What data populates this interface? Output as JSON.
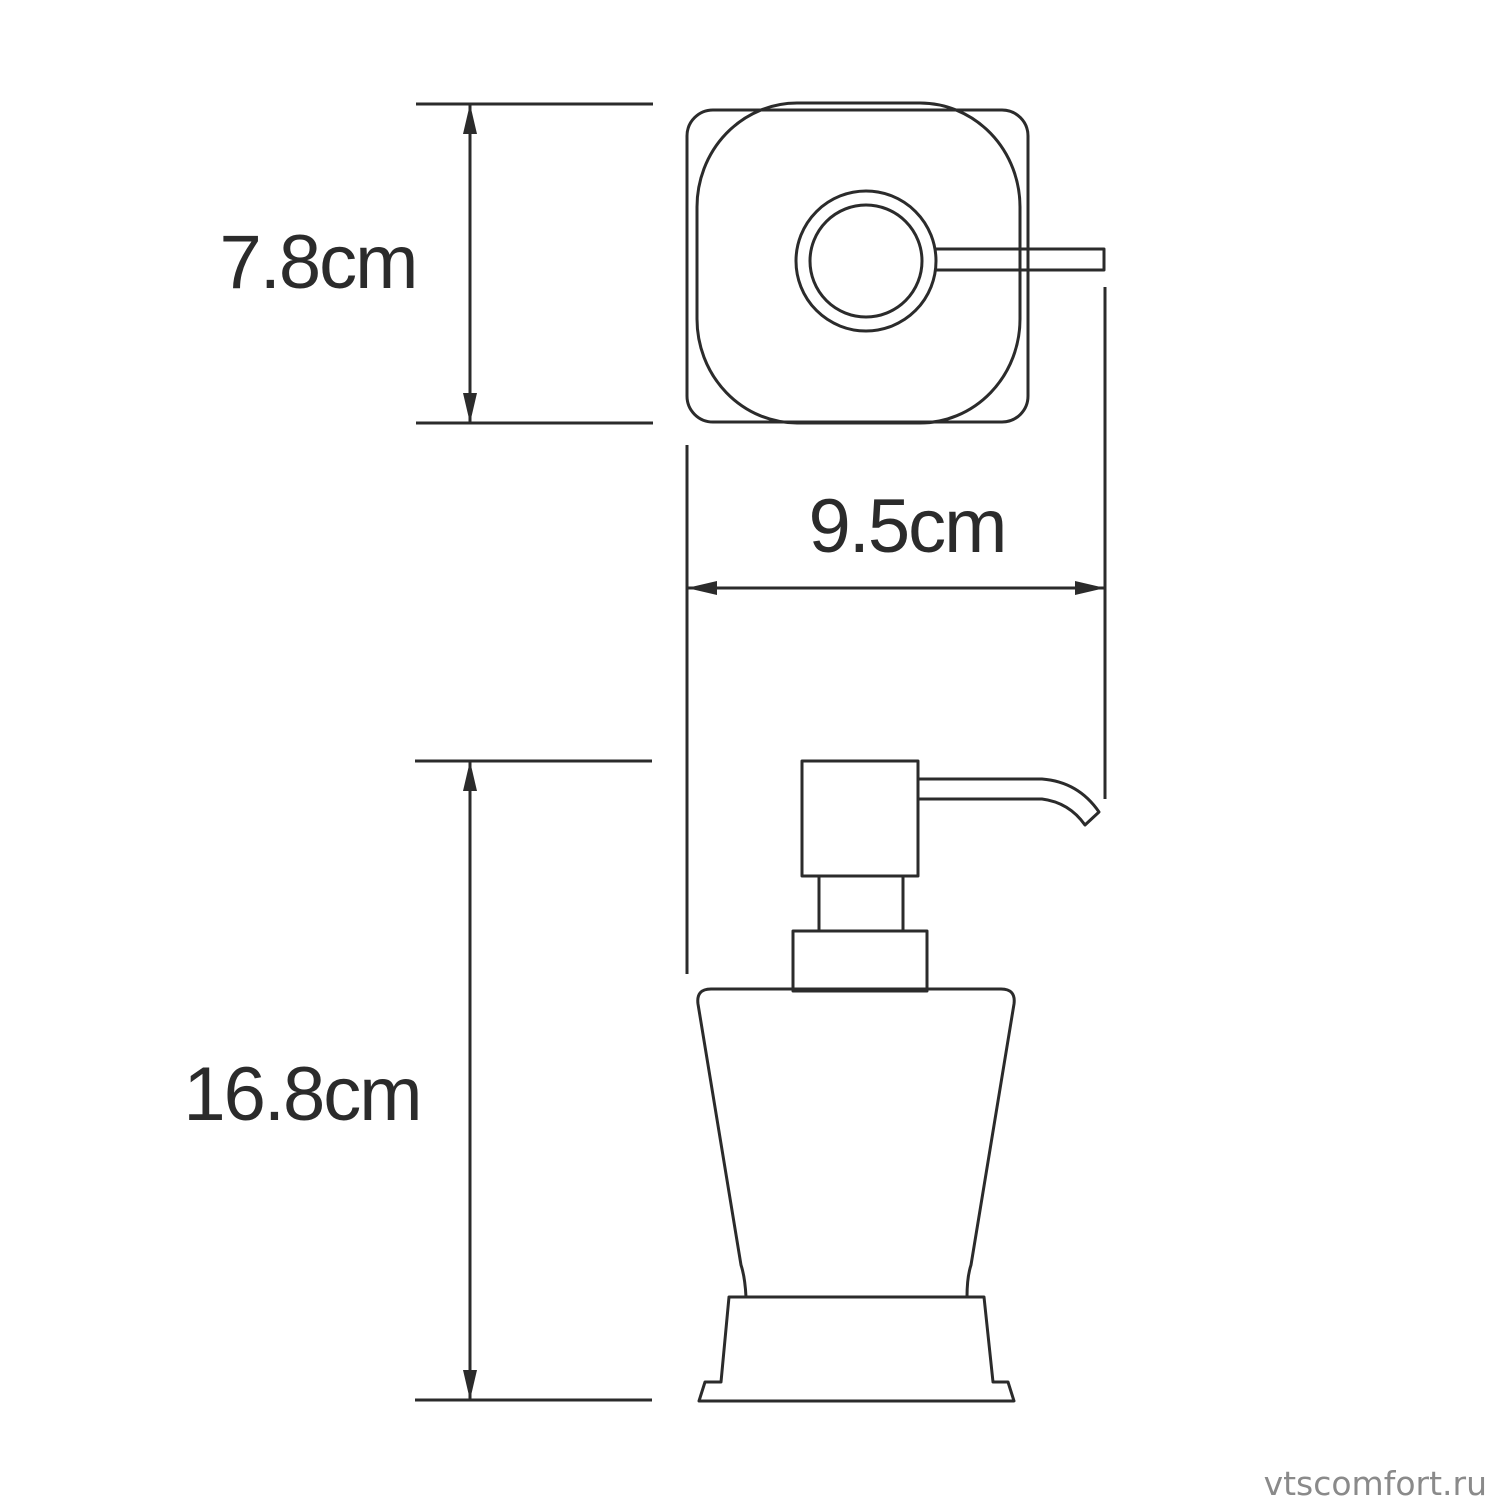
{
  "page": {
    "background": "#ffffff"
  },
  "drawing": {
    "subject": "soap-dispenser-technical-drawing",
    "line_color": "#2b2b2b",
    "dimensions": {
      "depth": {
        "label": "7.8cm"
      },
      "width": {
        "label": "9.5cm"
      },
      "height": {
        "label": "16.8cm"
      }
    },
    "watermark": {
      "text": "vtscomfort.ru",
      "color": "#8a8a8a"
    }
  }
}
